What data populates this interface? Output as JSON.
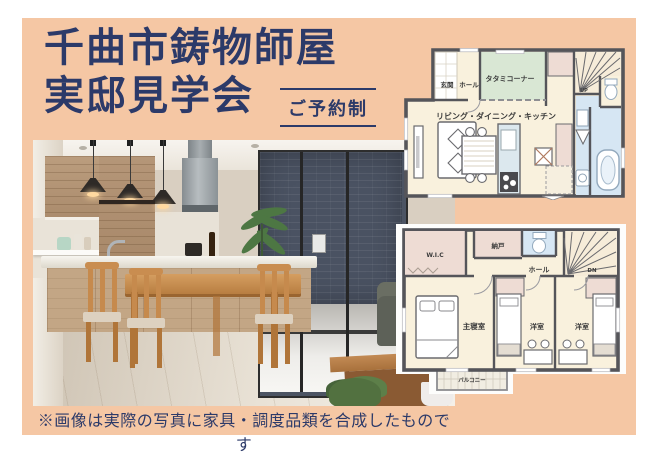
{
  "colors": {
    "panel_bg": "#f5c7a4",
    "title_navy": "#2c3a69",
    "plan_wall": "#55555a",
    "plan_floor": "#f9f1dd",
    "plan_tatami_green": "#d9e7d4",
    "plan_closet_pink": "#eedcd4",
    "plan_bath_blue": "#d6e6f3"
  },
  "header": {
    "title_line1": "千曲市鋳物師屋",
    "title_line2": "実邸見学会",
    "badge_label": "ご予約制"
  },
  "caption": {
    "text": "※画像は実際の写真に家具・調度品類を合成したものです"
  },
  "floorplan_1f": {
    "labels": {
      "entrance": "玄関",
      "hall": "ホール",
      "tatami": "タタミコーナー",
      "ldk": "リビング・ダイニング・キッチン",
      "stairs_up": "UP"
    }
  },
  "floorplan_2f": {
    "labels": {
      "wic": "W.I.C",
      "storage": "納戸",
      "hall": "ホール",
      "stairs_dn": "DN",
      "master": "主寝室",
      "western1": "洋室",
      "western2": "洋室",
      "balcony": "バルコニー"
    }
  }
}
